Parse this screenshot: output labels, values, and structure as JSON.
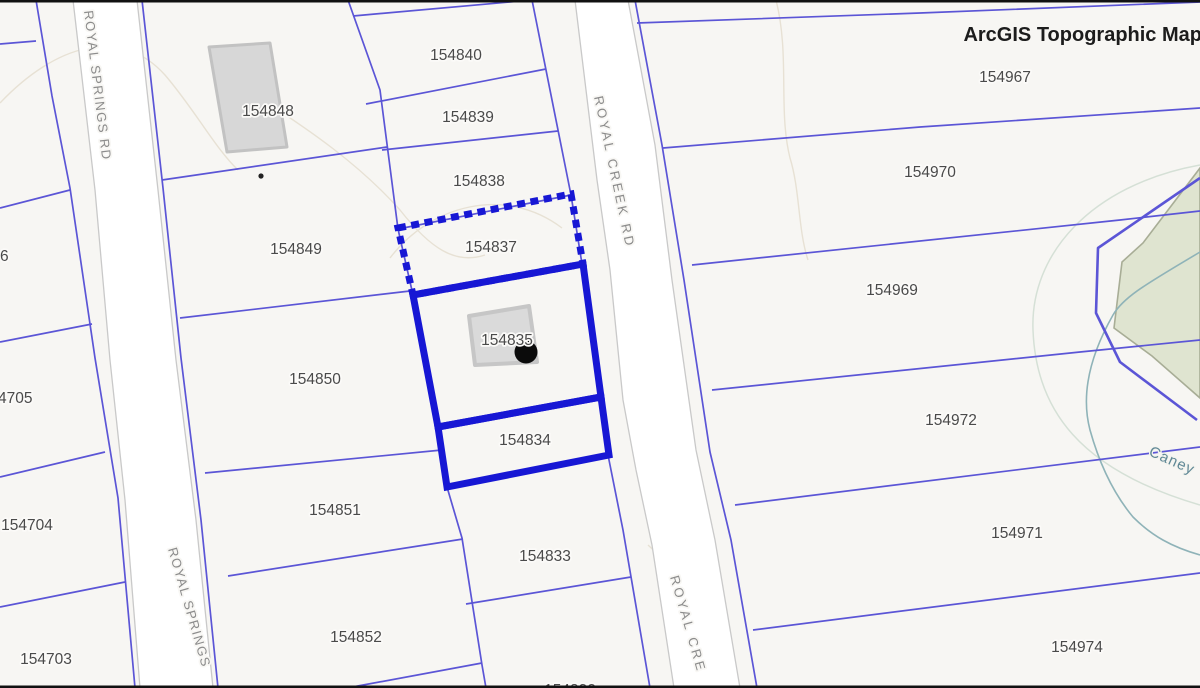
{
  "map": {
    "title": "ArcGIS Topographic Map",
    "parcels": [
      {
        "label": "154840"
      },
      {
        "label": "154839"
      },
      {
        "label": "154838"
      },
      {
        "label": "154837"
      },
      {
        "label": "154835"
      },
      {
        "label": "154834"
      },
      {
        "label": "154833"
      },
      {
        "label": "154832"
      },
      {
        "label": "154848"
      },
      {
        "label": "154849"
      },
      {
        "label": "154850"
      },
      {
        "label": "154851"
      },
      {
        "label": "154852"
      },
      {
        "label": "154967"
      },
      {
        "label": "154970"
      },
      {
        "label": "154969"
      },
      {
        "label": "154972"
      },
      {
        "label": "154971"
      },
      {
        "label": "154974"
      },
      {
        "label": "6"
      },
      {
        "label": "4705"
      },
      {
        "label": "154704"
      },
      {
        "label": "154703"
      }
    ],
    "road_labels": [
      {
        "text": "ROYAL SPRINGS RD"
      },
      {
        "text": "ROYAL SPRINGS"
      },
      {
        "text": "ROYAL CREEK RD"
      },
      {
        "text": "ROYAL CRE"
      }
    ],
    "water": {
      "label": "Caney"
    },
    "highlight": {
      "dashed_parcel": "154837",
      "solid_parcels": [
        "154835",
        "154834"
      ]
    },
    "colors": {
      "background": "#f7f6f3",
      "parcel_line": "#5b55d6",
      "highlight": "#1717d4",
      "road_fill": "#ffffff",
      "road_casing": "#c9c9c9",
      "building": "#d7d7d7",
      "green_area": "#dfe4d0",
      "water_line": "#8fb3b8",
      "label_text": "#4a4a4a"
    }
  }
}
